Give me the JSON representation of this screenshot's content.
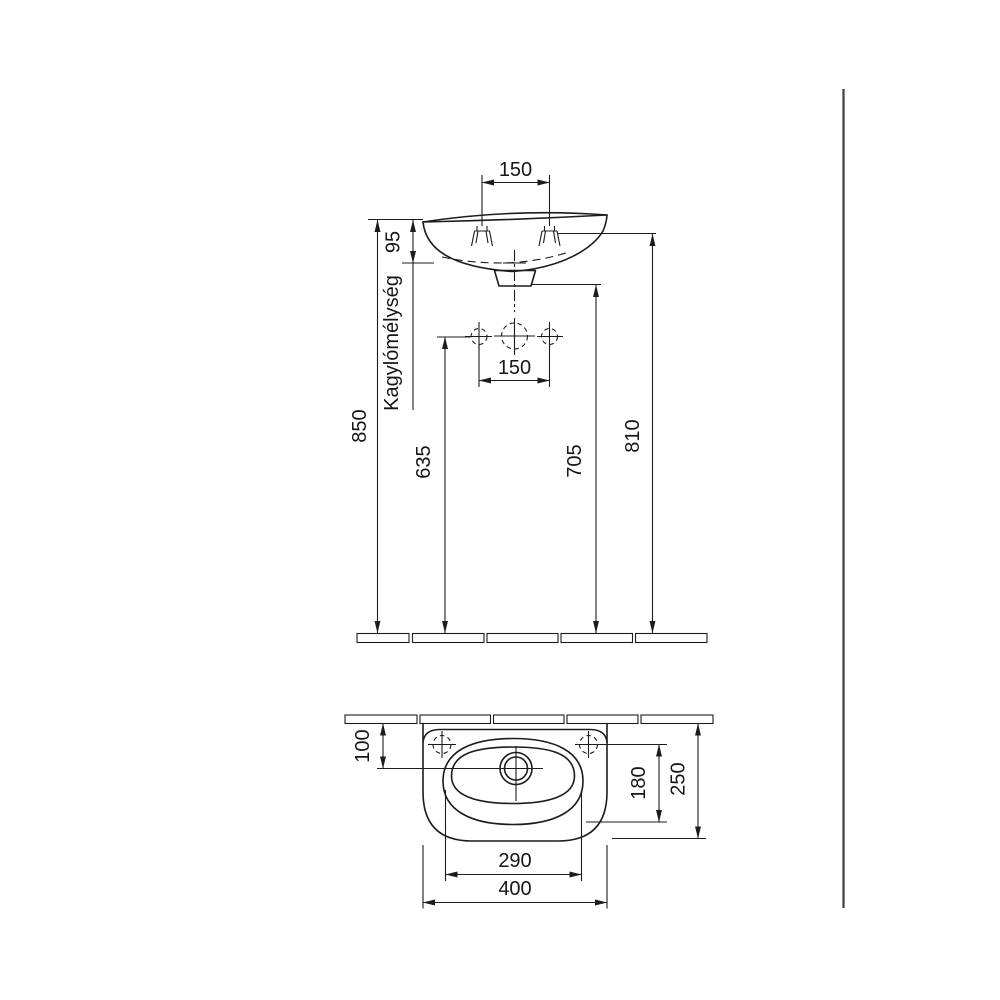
{
  "page": {
    "background": "#ffffff",
    "line_color": "#1c1c1c",
    "separator_color": "#3f3f3f"
  },
  "drawing": {
    "type": "technical-drawing",
    "subject": "wall-hung washbasin installation dimensions (front elevation and plan view)",
    "front_view": {
      "tap_hole_spacing_top": "150",
      "rim_to_bowl_bottom": "95",
      "bowl_depth_label": "Kagylómélység",
      "rim_height_from_floor": "850",
      "fixing_holes_height": "635",
      "fixing_hole_spacing": "150",
      "drain_outlet_height": "705",
      "bracket_height": "810"
    },
    "plan_view": {
      "wall_to_drain_center": "100",
      "tap_line_to_bowl_front": "180",
      "overall_depth": "250",
      "bowl_width": "290",
      "overall_width": "400"
    }
  }
}
